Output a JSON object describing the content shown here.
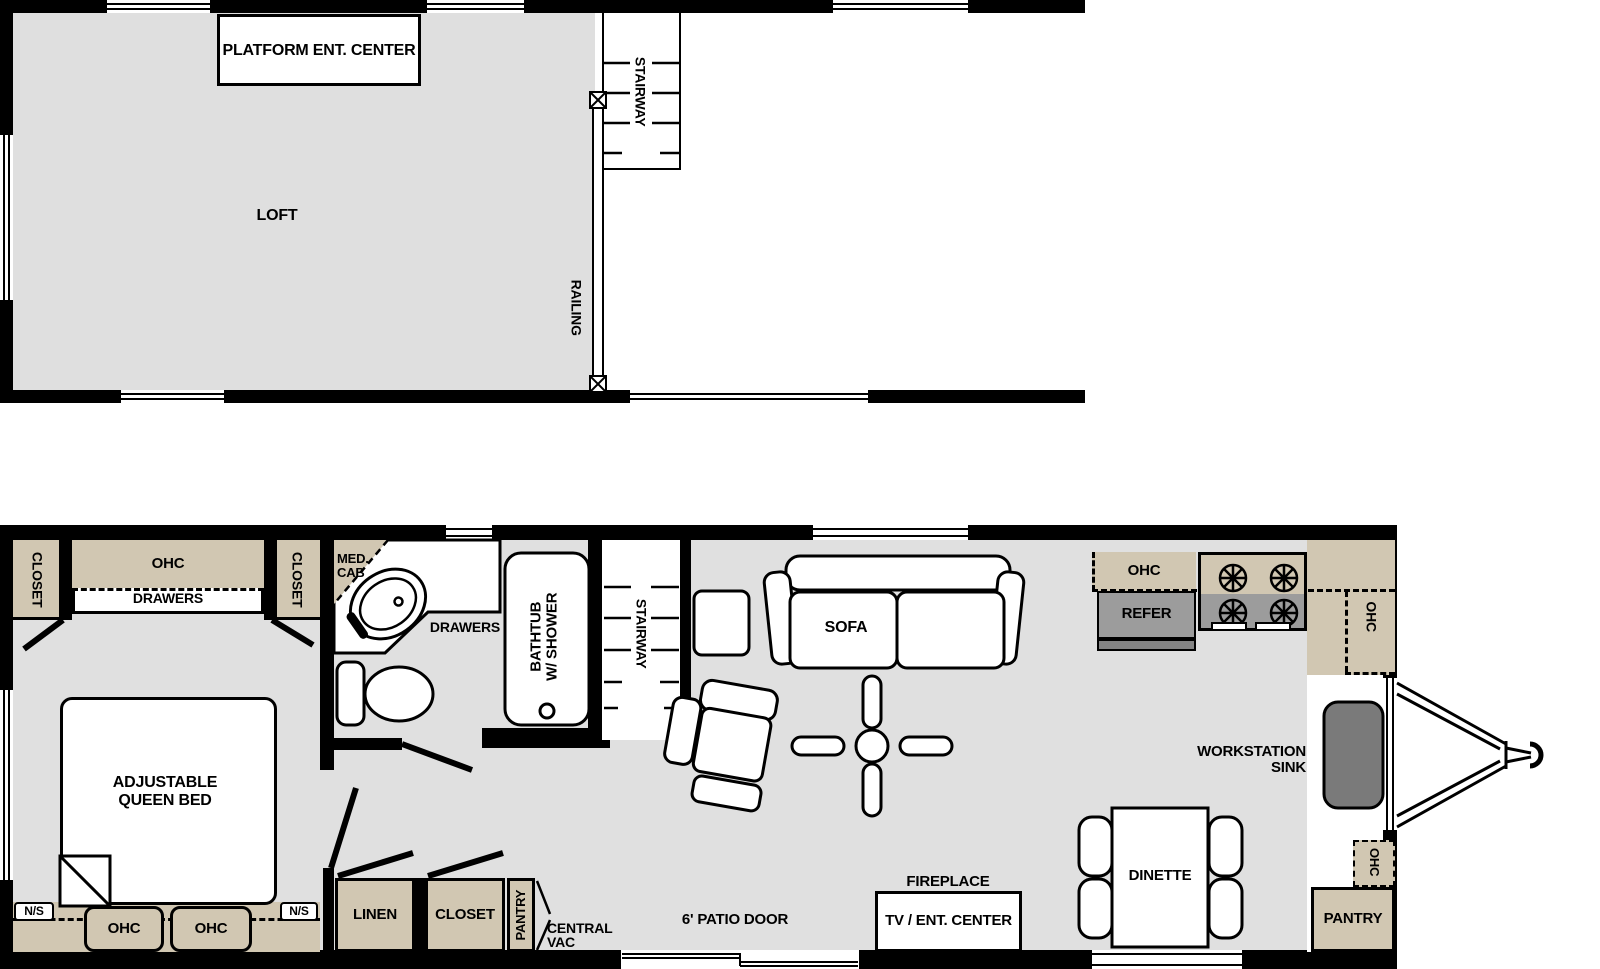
{
  "title": "Park model floor plan",
  "colors": {
    "wall": "#000000",
    "floor_gray": "#e0e0e0",
    "cabinet_tan": "#d1c7b2",
    "appliance_gray": "#9c9c9c",
    "sink_gray": "#7a7a7a"
  },
  "loft_plan": {
    "platform_ent_center": "PLATFORM ENT. CENTER",
    "loft": "LOFT",
    "stairway": "STAIRWAY",
    "railing": "RAILING"
  },
  "main_plan": {
    "bedroom": {
      "closet_left": "CLOSET",
      "ohc_top": "OHC",
      "drawers": "DRAWERS",
      "closet_right": "CLOSET",
      "bed_line1": "ADJUSTABLE",
      "bed_line2": "QUEEN BED",
      "ns_left": "N/S",
      "ns_right": "N/S",
      "ohc_bottom_left": "OHC",
      "ohc_bottom_right": "OHC"
    },
    "bathroom": {
      "med_cab_line1": "MED.",
      "med_cab_line2": "CAB",
      "drawers": "DRAWERS",
      "bathtub_line1": "BATHTUB",
      "bathtub_line2": "W/ SHOWER",
      "stairway": "STAIRWAY"
    },
    "hallway": {
      "linen": "LINEN",
      "closet": "CLOSET",
      "pantry": "PANTRY",
      "central_vac_line1": "CENTRAL",
      "central_vac_line2": "VAC"
    },
    "living": {
      "sofa": "SOFA",
      "patio_door": "6' PATIO DOOR",
      "fireplace": "FIREPLACE",
      "tv_ent_center": "TV / ENT. CENTER"
    },
    "kitchen": {
      "ohc_top": "OHC",
      "refer": "REFER",
      "ohc_right": "OHC",
      "sink_line1": "WORKSTATION",
      "sink_line2": "SINK",
      "dinette": "DINETTE",
      "ohc_bottom": "OHC",
      "pantry": "PANTRY"
    }
  }
}
